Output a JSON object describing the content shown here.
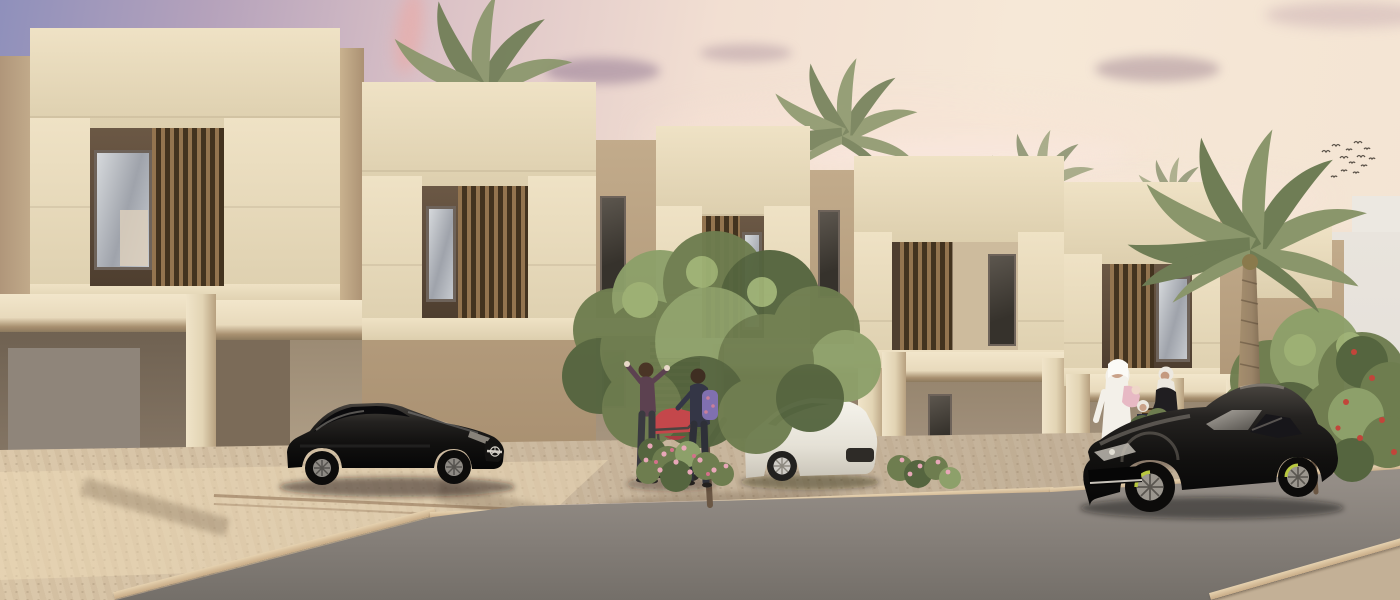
{
  "scene": {
    "type": "architectural-render",
    "setting": "residential street of modern townhouses at dusk",
    "description": "Row of five two-storey sand-coloured townhouses with cream parapet frames, recessed wood-louvered balconies and open carports; paved driveways, an asphalt street, palm trees, leafy trees, flowering shrubs, residents and luxury cars under a pink sunset sky",
    "time_of_day": "sunset / dusk",
    "visible_text": "none"
  },
  "palette": {
    "sky-top": "#8f90bb",
    "sky-mauve": "#b5a2bb",
    "sky-pink": "#dcc3c7",
    "sky-cream": "#f2dfd2",
    "sky-peach": "#f6e8d7",
    "facade-cream": "#efe2c5",
    "facade-cream-dark": "#ddcfae",
    "facade-tan": "#c2ab8b",
    "facade-tan-dark": "#a78e6f",
    "side-shadow": "#b0967a",
    "recess-dark": "#4e3e2f",
    "recess-mid": "#6b5845",
    "louver-wood": "#93744f",
    "louver-gap": "#43331f",
    "beam-underside": "#a89070",
    "window-frame": "#6e635a",
    "glass-light": "#d6d9dc",
    "glass-dark": "#9fa3ab",
    "curtain": "#dccfbc",
    "carport1": "#887968",
    "carport2": "#b2a189",
    "carport-divider": "#7b6b58",
    "garage-gray": "#8f857a",
    "bg-building": "#e3dfd8",
    "bg-building2": "#d5cfc7",
    "bg-building3": "#ece8e1",
    "pavement": "#c9b79e",
    "pavement-light": "#dcc9ab",
    "curb": "#c8ab86",
    "road": "#948d86",
    "road-dark": "#746f69",
    "foliage": "#6e7d4f",
    "foliage-light": "#8da06a",
    "foliage-dark": "#55653f",
    "palm-green": "#8a966b",
    "palm-dark": "#6f7d55",
    "trunk": "#9a8468",
    "trunk-dark": "#7c6950",
    "car-black": "#1b1917",
    "car-white": "#efece3",
    "metal-highlight": "#b9b4ac",
    "flower-pink": "#e8a7b8",
    "flower-red": "#c2453a",
    "thobe-white": "#f3f0e9",
    "abaya-black": "#201e21",
    "hijab-white": "#ece8e0",
    "stroller-red": "#c4474b",
    "backpack-purple": "#8070b0",
    "bird": "#5a5248",
    "lamp-glow": "#f7e7b5"
  },
  "sky": {
    "clouds": "soft pink and mauve dusk wisps, denser on the right half",
    "birds": {
      "count": 13,
      "location": "upper right sky, loose flock"
    }
  },
  "architecture": {
    "townhouse_count": 5,
    "floors": 2,
    "features": [
      "cream parapet picture-frames on upper floor",
      "recessed balconies with vertical timber louvers",
      "reflective bedroom windows",
      "sand-tan infill walls",
      "open carports with cream beams and columns",
      "louvered entry doors",
      "warm wall sconce in second carport"
    ],
    "background": "pale grey-white low-rise buildings behind the row, right side"
  },
  "vehicles": [
    {
      "name": "black gullwing sports coupe (Mercedes SLS style)",
      "color": "black",
      "location": "parked in second carport, left of centre",
      "details": "chrome grille bar with three-pointed star emblem"
    },
    {
      "name": "white luxury coupe",
      "color": "white",
      "location": "parked in middle carport, partly hidden behind tree"
    },
    {
      "name": "black luxury fastback sedan (Porsche Panamera style)",
      "color": "black",
      "location": "driving on the street, right side, facing left",
      "details": "lime-green brake calipers"
    }
  ],
  "people": [
    {
      "name": "woman in plum top",
      "action": "walking, arm raised",
      "location": "walkway in front of house 2"
    },
    {
      "name": "woman with purple backpack",
      "action": "pushing red stroller",
      "location": "walkway in front of house 2"
    },
    {
      "name": "man in white thobe and ghutra",
      "action": "standing, carrying child in pink",
      "location": "in front of house 5, behind sedan"
    },
    {
      "name": "woman in black abaya with white hijab",
      "action": "standing, holding child's hand",
      "location": "in front of house 5"
    },
    {
      "name": "small girl in white hijab",
      "action": "standing between the adults",
      "location": "in front of house 5"
    }
  ],
  "vegetation": [
    {
      "name": "palm tree",
      "location": "behind house 1 roofline"
    },
    {
      "name": "palm tree",
      "location": "behind house 3 roofline"
    },
    {
      "name": "palm tree (hazy)",
      "location": "behind house 4 roofline"
    },
    {
      "name": "tall date palm",
      "location": "right of house 5, in front of background buildings"
    },
    {
      "name": "leafy street tree",
      "location": "centre, in front of middle carport"
    },
    {
      "name": "leafy street tree",
      "location": "far right, behind the sedan"
    },
    {
      "name": "pink flowering shrub",
      "location": "at stroller, centre walkway"
    },
    {
      "name": "pink flowering shrub",
      "location": "right of centre tree"
    },
    {
      "name": "red flowering shrub",
      "location": "far right edge"
    },
    {
      "name": "green shrub",
      "location": "in front of family, by sedan hood"
    }
  ],
  "ground": {
    "surfaces": [
      "beige cobble driveways and sidewalk with sunlit patches",
      "light stone curbs",
      "grey asphalt street",
      "cobble strip in near foreground, bottom right"
    ],
    "shadows": "long warm shadows from columns and trees across the paving"
  }
}
